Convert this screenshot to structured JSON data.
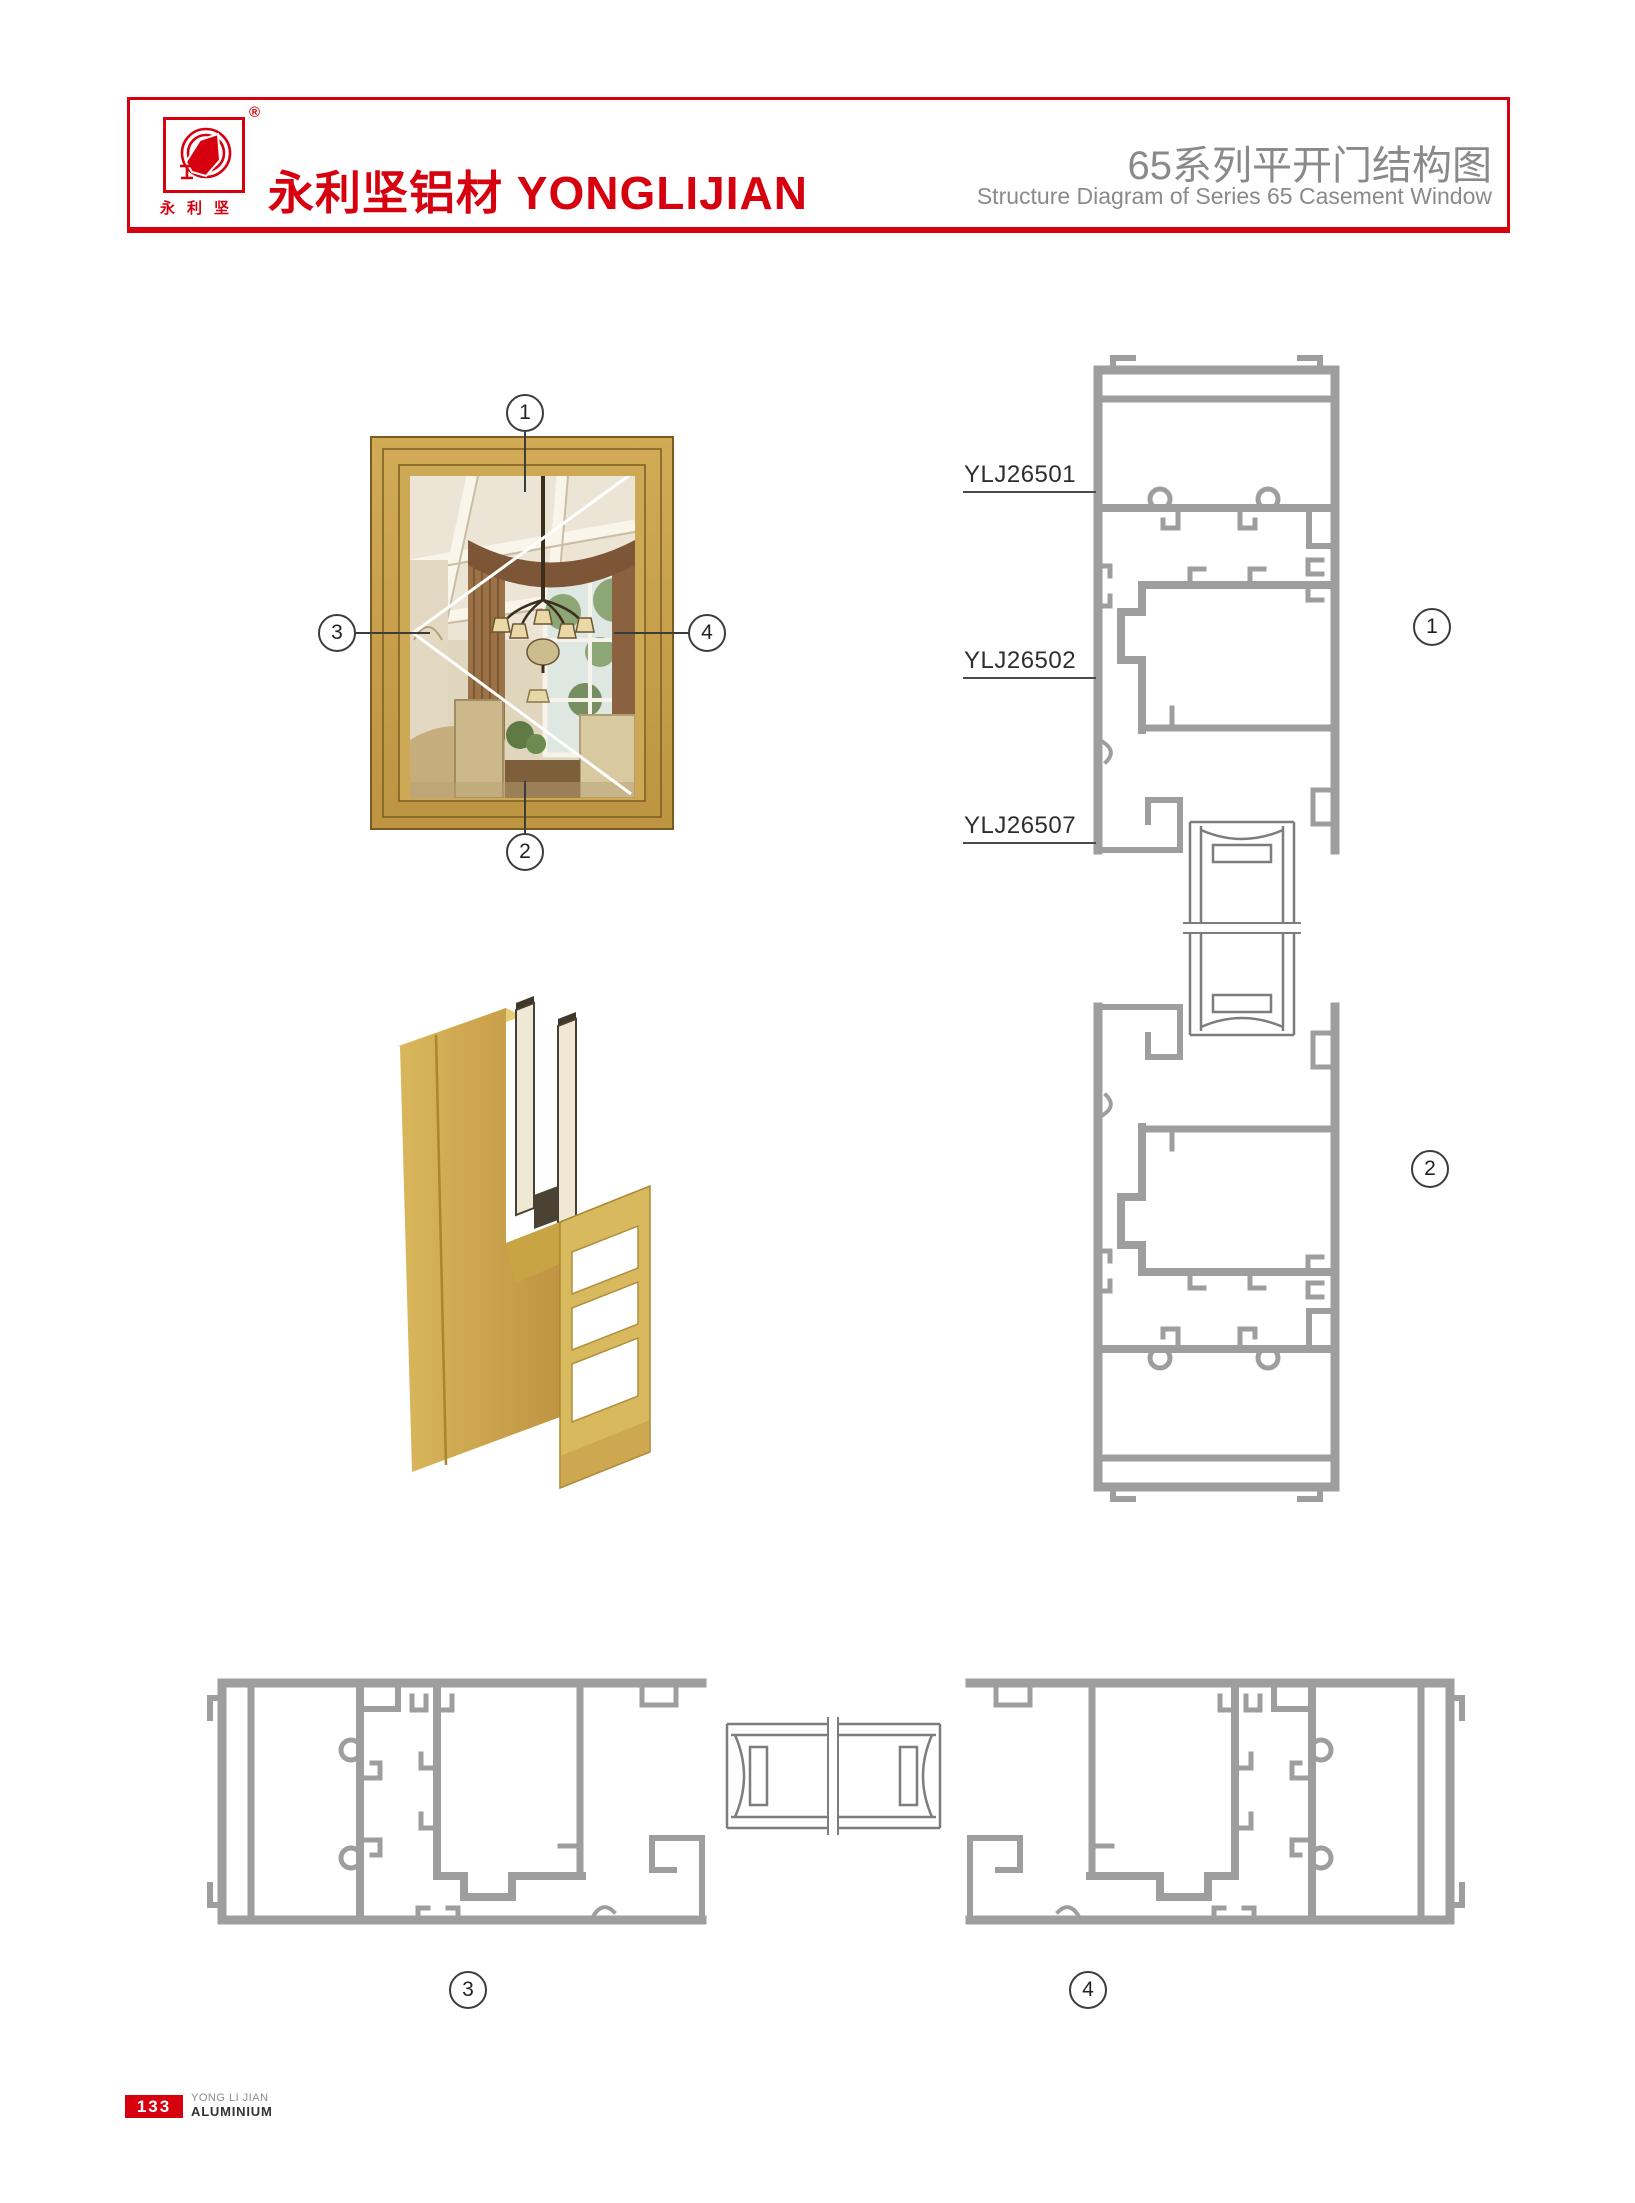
{
  "header": {
    "brand": "永利坚铝材 YONGLIJIAN",
    "logo_chars": "永利坚",
    "registered_mark": "®",
    "title_cn": "65系列平开门结构图",
    "title_en": "Structure Diagram of Series 65 Casement Window"
  },
  "window_diagram": {
    "callout_top": "1",
    "callout_bottom": "2",
    "callout_left": "3",
    "callout_right": "4"
  },
  "vertical_sections": {
    "labels": [
      {
        "code": "YLJ26501"
      },
      {
        "code": "YLJ26502"
      },
      {
        "code": "YLJ26507"
      }
    ],
    "callout_top": "1",
    "callout_bottom": "2"
  },
  "horizontal_sections": {
    "callout_left": "3",
    "callout_right": "4"
  },
  "footer": {
    "page": "133",
    "company_line1": "YONG LI JIAN",
    "company_line2": "ALUMINIUM"
  },
  "colors": {
    "accent_red": "#d6000f",
    "title_gray": "#8a8a8a",
    "profile_gray": "#9e9e9e",
    "frame_gold": "#c7a14f"
  }
}
